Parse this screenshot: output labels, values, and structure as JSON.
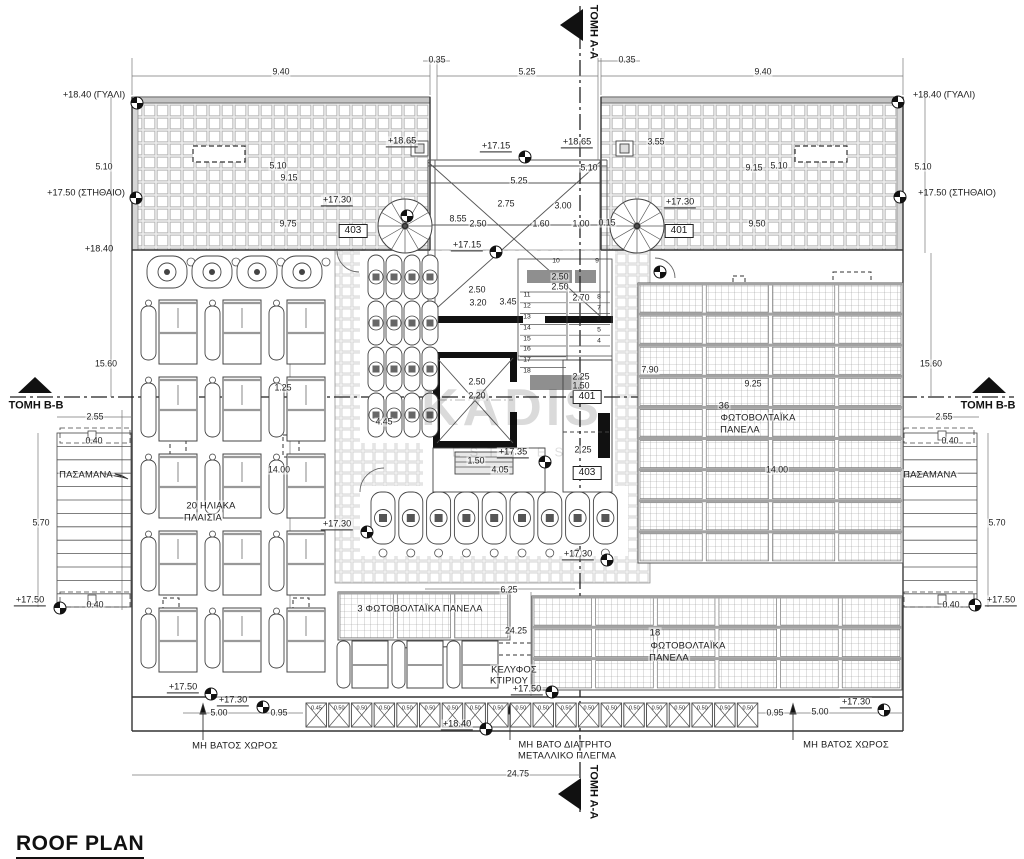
{
  "title": "ROOF PLAN",
  "watermark": {
    "line1": "KADIS",
    "line2": "ESTATES"
  },
  "colors": {
    "line": "#444",
    "hatch": "#b5b5b5",
    "panel_band": "#9c9c9c",
    "black": "#111"
  },
  "walkway": {
    "values": [
      "0.45",
      "0.50",
      "0.50",
      "0.50",
      "0.50",
      "0.50",
      "0.50",
      "0.50",
      "0.50",
      "0.50",
      "0.50",
      "0.50",
      "0.50",
      "0.50",
      "0.50",
      "0.50",
      "0.50",
      "0.50",
      "0.50",
      "0.50"
    ]
  },
  "labels": [
    {
      "t": "ΤΟΜΗ Α-Α",
      "x": 593,
      "y": 32,
      "c": "s",
      "r": 90
    },
    {
      "t": "ΤΟΜΗ Α-Α",
      "x": 593,
      "y": 792,
      "c": "s",
      "r": 90
    },
    {
      "t": "ΤΟΜΗ Β-Β",
      "x": 36,
      "y": 406,
      "c": "s"
    },
    {
      "t": "ΤΟΜΗ Β-Β",
      "x": 988,
      "y": 406,
      "c": "s"
    },
    {
      "t": "0.35",
      "x": 437,
      "y": 60
    },
    {
      "t": "0.35",
      "x": 627,
      "y": 60
    },
    {
      "t": "9.40",
      "x": 281,
      "y": 72
    },
    {
      "t": "5.25",
      "x": 527,
      "y": 72
    },
    {
      "t": "9.40",
      "x": 763,
      "y": 72
    },
    {
      "t": "+18.40 (ΓΥΑΛΙ)",
      "x": 94,
      "y": 95,
      "c": "p"
    },
    {
      "t": "+18.40 (ΓΥΑΛΙ)",
      "x": 944,
      "y": 95,
      "c": "p"
    },
    {
      "t": "5.10",
      "x": 104,
      "y": 167
    },
    {
      "t": "5.10",
      "x": 923,
      "y": 167
    },
    {
      "t": "+17.50 (ΣΤΗΘΑΙΟ)",
      "x": 86,
      "y": 193,
      "c": "p"
    },
    {
      "t": "+17.50 (ΣΤΗΘΑΙΟ)",
      "x": 957,
      "y": 193,
      "c": "p"
    },
    {
      "t": "+18.40",
      "x": 99,
      "y": 249,
      "c": "p"
    },
    {
      "t": "5.10",
      "x": 278,
      "y": 166
    },
    {
      "t": "9.15",
      "x": 289,
      "y": 178
    },
    {
      "t": "9.15",
      "x": 754,
      "y": 168
    },
    {
      "t": "5.10",
      "x": 779,
      "y": 166
    },
    {
      "t": "9.75",
      "x": 288,
      "y": 224
    },
    {
      "t": "9.50",
      "x": 757,
      "y": 224
    },
    {
      "t": "+18.65",
      "x": 402,
      "y": 142,
      "c": "l"
    },
    {
      "t": "+17.15",
      "x": 496,
      "y": 147,
      "c": "l"
    },
    {
      "t": "+18.65",
      "x": 577,
      "y": 143,
      "c": "l"
    },
    {
      "t": "3.55",
      "x": 656,
      "y": 142
    },
    {
      "t": "5.10",
      "x": 589,
      "y": 168
    },
    {
      "t": "5.25",
      "x": 519,
      "y": 181
    },
    {
      "t": "2.75",
      "x": 506,
      "y": 204
    },
    {
      "t": "3.00",
      "x": 563,
      "y": 206
    },
    {
      "t": "8.55",
      "x": 458,
      "y": 219
    },
    {
      "t": "2.50",
      "x": 478,
      "y": 224
    },
    {
      "t": "1.60",
      "x": 541,
      "y": 224
    },
    {
      "t": "1.00",
      "x": 581,
      "y": 224
    },
    {
      "t": "0.15",
      "x": 607,
      "y": 223
    },
    {
      "t": "+17.30",
      "x": 337,
      "y": 201,
      "c": "l"
    },
    {
      "t": "+17.30",
      "x": 680,
      "y": 203,
      "c": "l"
    },
    {
      "t": "+17.15",
      "x": 467,
      "y": 246,
      "c": "l"
    },
    {
      "t": "403",
      "x": 353,
      "y": 231,
      "c": "b"
    },
    {
      "t": "401",
      "x": 679,
      "y": 231,
      "c": "b"
    },
    {
      "t": "401",
      "x": 587,
      "y": 397,
      "c": "b"
    },
    {
      "t": "403",
      "x": 587,
      "y": 473,
      "c": "b"
    },
    {
      "t": "10",
      "x": 556,
      "y": 262,
      "c": "t"
    },
    {
      "t": "9",
      "x": 597,
      "y": 262,
      "c": "t"
    },
    {
      "t": "2.50",
      "x": 560,
      "y": 277
    },
    {
      "t": "2.50",
      "x": 560,
      "y": 287
    },
    {
      "t": "2.50",
      "x": 477,
      "y": 290
    },
    {
      "t": "3.20",
      "x": 478,
      "y": 303
    },
    {
      "t": "3.45",
      "x": 508,
      "y": 302
    },
    {
      "t": "11",
      "x": 527,
      "y": 296,
      "c": "t"
    },
    {
      "t": "12",
      "x": 527,
      "y": 307,
      "c": "t"
    },
    {
      "t": "13",
      "x": 527,
      "y": 318,
      "c": "t"
    },
    {
      "t": "14",
      "x": 527,
      "y": 329,
      "c": "t"
    },
    {
      "t": "15",
      "x": 527,
      "y": 340,
      "c": "t"
    },
    {
      "t": "16",
      "x": 527,
      "y": 350,
      "c": "t"
    },
    {
      "t": "17",
      "x": 527,
      "y": 361,
      "c": "t"
    },
    {
      "t": "18",
      "x": 527,
      "y": 372,
      "c": "t"
    },
    {
      "t": "2.70",
      "x": 581,
      "y": 298
    },
    {
      "t": "8",
      "x": 599,
      "y": 298,
      "c": "t"
    },
    {
      "t": "7",
      "x": 599,
      "y": 309,
      "c": "t"
    },
    {
      "t": "6",
      "x": 599,
      "y": 320,
      "c": "t"
    },
    {
      "t": "5",
      "x": 599,
      "y": 331,
      "c": "t"
    },
    {
      "t": "4",
      "x": 599,
      "y": 342,
      "c": "t"
    },
    {
      "t": "2.50",
      "x": 477,
      "y": 382
    },
    {
      "t": "2.20",
      "x": 477,
      "y": 396
    },
    {
      "t": "2.25",
      "x": 581,
      "y": 377
    },
    {
      "t": "1.50",
      "x": 581,
      "y": 386
    },
    {
      "t": "2.25",
      "x": 583,
      "y": 450
    },
    {
      "t": "+17.35",
      "x": 513,
      "y": 453,
      "c": "l"
    },
    {
      "t": "1.50",
      "x": 476,
      "y": 461
    },
    {
      "t": "4.05",
      "x": 500,
      "y": 470
    },
    {
      "t": "4.45",
      "x": 384,
      "y": 422
    },
    {
      "t": "1.25",
      "x": 283,
      "y": 388
    },
    {
      "t": "14.00",
      "x": 279,
      "y": 470
    },
    {
      "t": "20 ΗΛΙΑΚΑ",
      "x": 211,
      "y": 505,
      "c": "a"
    },
    {
      "t": "ΠΛΑΙΣΙΑ",
      "x": 203,
      "y": 517,
      "c": "a"
    },
    {
      "t": "+17.30",
      "x": 337,
      "y": 525,
      "c": "l"
    },
    {
      "t": "7.90",
      "x": 650,
      "y": 370
    },
    {
      "t": "9.25",
      "x": 753,
      "y": 384
    },
    {
      "t": "36",
      "x": 724,
      "y": 405,
      "c": "a"
    },
    {
      "t": "ΦΩΤΟΒΟΛΤΑΪΚΑ",
      "x": 758,
      "y": 417,
      "c": "a"
    },
    {
      "t": "ΠΑΝΕΛΑ",
      "x": 740,
      "y": 429,
      "c": "a"
    },
    {
      "t": "14.00",
      "x": 777,
      "y": 470
    },
    {
      "t": "+17.30",
      "x": 578,
      "y": 555,
      "c": "l"
    },
    {
      "t": "6.25",
      "x": 509,
      "y": 590
    },
    {
      "t": "3 ΦΩΤΟΒΟΛΤΑΪΚΑ ΠΑΝΕΛΑ",
      "x": 420,
      "y": 608,
      "c": "a"
    },
    {
      "t": "24.25",
      "x": 516,
      "y": 631
    },
    {
      "t": "ΚΕΛΥΦΟΣ",
      "x": 514,
      "y": 669,
      "c": "a"
    },
    {
      "t": "ΚΤΙΡΙΟΥ",
      "x": 509,
      "y": 680,
      "c": "a"
    },
    {
      "t": "+17.50",
      "x": 527,
      "y": 690,
      "c": "l"
    },
    {
      "t": "18",
      "x": 655,
      "y": 632,
      "c": "a"
    },
    {
      "t": "ΦΩΤΟΒΟΛΤΑΪΚΑ",
      "x": 688,
      "y": 645,
      "c": "a"
    },
    {
      "t": "ΠΑΝΕΛΑ",
      "x": 669,
      "y": 657,
      "c": "a"
    },
    {
      "t": "+17.50",
      "x": 183,
      "y": 688,
      "c": "l"
    },
    {
      "t": "+17.30",
      "x": 233,
      "y": 701,
      "c": "l"
    },
    {
      "t": "5.00",
      "x": 219,
      "y": 713
    },
    {
      "t": "0.95",
      "x": 279,
      "y": 713
    },
    {
      "t": "ΜΗ ΒΑΤΟΣ ΧΩΡΟΣ",
      "x": 235,
      "y": 745,
      "c": "a"
    },
    {
      "t": "0.95",
      "x": 775,
      "y": 713
    },
    {
      "t": "5.00",
      "x": 820,
      "y": 712
    },
    {
      "t": "+17.30",
      "x": 856,
      "y": 703,
      "c": "l"
    },
    {
      "t": "ΜΗ ΒΑΤΟΣ ΧΩΡΟΣ",
      "x": 846,
      "y": 744,
      "c": "a"
    },
    {
      "t": "+18.40",
      "x": 457,
      "y": 725,
      "c": "l"
    },
    {
      "t": "24.75",
      "x": 518,
      "y": 774
    },
    {
      "t": "ΜΗ ΒΑΤΟ ΔΙΑΤΡΗΤΟ",
      "x": 565,
      "y": 744,
      "c": "a"
    },
    {
      "t": "ΜΕΤΑΛΛΙΚΟ ΠΛΕΓΜΑ",
      "x": 567,
      "y": 755,
      "c": "a"
    },
    {
      "t": "15.60",
      "x": 106,
      "y": 364
    },
    {
      "t": "2.55",
      "x": 95,
      "y": 417
    },
    {
      "t": "0.40",
      "x": 94,
      "y": 441
    },
    {
      "t": "ΠΑΣΑΜΑΝΑ",
      "x": 86,
      "y": 474,
      "c": "a"
    },
    {
      "t": "5.70",
      "x": 41,
      "y": 523
    },
    {
      "t": "+17.50",
      "x": 30,
      "y": 601,
      "c": "l"
    },
    {
      "t": "0.40",
      "x": 95,
      "y": 605
    },
    {
      "t": "15.60",
      "x": 931,
      "y": 364
    },
    {
      "t": "2.55",
      "x": 944,
      "y": 417
    },
    {
      "t": "0.40",
      "x": 950,
      "y": 441
    },
    {
      "t": "ΠΑΣΑΜΑΝΑ",
      "x": 930,
      "y": 474,
      "c": "a"
    },
    {
      "t": "5.70",
      "x": 997,
      "y": 523
    },
    {
      "t": "0.40",
      "x": 951,
      "y": 605
    },
    {
      "t": "+17.50",
      "x": 1001,
      "y": 601,
      "c": "l"
    }
  ]
}
